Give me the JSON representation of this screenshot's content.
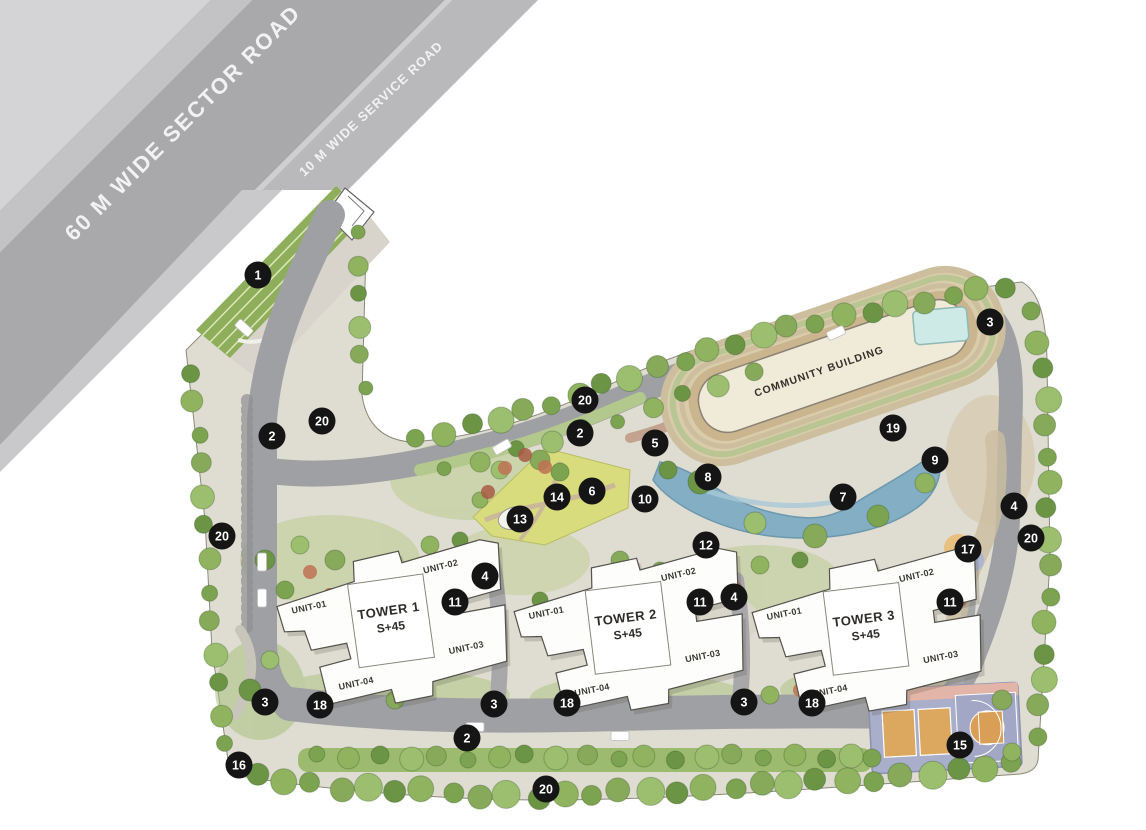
{
  "plan": {
    "roads": {
      "sector_label": "60 M WIDE SECTOR ROAD",
      "service_label": "10 M WIDE SERVICE ROAD"
    },
    "community_building": {
      "label": "COMMUNITY BUILDING"
    },
    "towers": [
      {
        "name": "TOWER 1",
        "floors": "S+45",
        "units": [
          "UNIT-01",
          "UNIT-02",
          "UNIT-03",
          "UNIT-04"
        ],
        "cx": 390,
        "cy": 621,
        "rot": -8
      },
      {
        "name": "TOWER 2",
        "floors": "S+45",
        "units": [
          "UNIT-01",
          "UNIT-02",
          "UNIT-03",
          "UNIT-04"
        ],
        "cx": 627,
        "cy": 628,
        "rot": -7
      },
      {
        "name": "TOWER 3",
        "floors": "S+45",
        "units": [
          "UNIT-01",
          "UNIT-02",
          "UNIT-03",
          "UNIT-04"
        ],
        "cx": 865,
        "cy": 629,
        "rot": -7
      }
    ],
    "markers": [
      {
        "n": "1",
        "x": 258,
        "y": 275
      },
      {
        "n": "2",
        "x": 272,
        "y": 436
      },
      {
        "n": "2",
        "x": 580,
        "y": 433
      },
      {
        "n": "2",
        "x": 467,
        "y": 738
      },
      {
        "n": "3",
        "x": 990,
        "y": 322
      },
      {
        "n": "3",
        "x": 265,
        "y": 702
      },
      {
        "n": "3",
        "x": 494,
        "y": 704
      },
      {
        "n": "3",
        "x": 744,
        "y": 702
      },
      {
        "n": "4",
        "x": 1014,
        "y": 506
      },
      {
        "n": "4",
        "x": 485,
        "y": 576
      },
      {
        "n": "4",
        "x": 734,
        "y": 597
      },
      {
        "n": "5",
        "x": 655,
        "y": 443
      },
      {
        "n": "6",
        "x": 592,
        "y": 491
      },
      {
        "n": "7",
        "x": 843,
        "y": 497
      },
      {
        "n": "8",
        "x": 708,
        "y": 477
      },
      {
        "n": "9",
        "x": 935,
        "y": 460
      },
      {
        "n": "10",
        "x": 645,
        "y": 499
      },
      {
        "n": "11",
        "x": 455,
        "y": 602
      },
      {
        "n": "11",
        "x": 700,
        "y": 602
      },
      {
        "n": "11",
        "x": 950,
        "y": 602
      },
      {
        "n": "12",
        "x": 706,
        "y": 545
      },
      {
        "n": "13",
        "x": 520,
        "y": 519
      },
      {
        "n": "14",
        "x": 557,
        "y": 497
      },
      {
        "n": "15",
        "x": 960,
        "y": 745
      },
      {
        "n": "16",
        "x": 239,
        "y": 765
      },
      {
        "n": "17",
        "x": 968,
        "y": 549
      },
      {
        "n": "18",
        "x": 320,
        "y": 705
      },
      {
        "n": "18",
        "x": 567,
        "y": 703
      },
      {
        "n": "18",
        "x": 812,
        "y": 703
      },
      {
        "n": "19",
        "x": 893,
        "y": 428
      },
      {
        "n": "20",
        "x": 322,
        "y": 421
      },
      {
        "n": "20",
        "x": 222,
        "y": 536
      },
      {
        "n": "20",
        "x": 585,
        "y": 400
      },
      {
        "n": "20",
        "x": 1031,
        "y": 538
      },
      {
        "n": "20",
        "x": 546,
        "y": 789
      }
    ]
  }
}
